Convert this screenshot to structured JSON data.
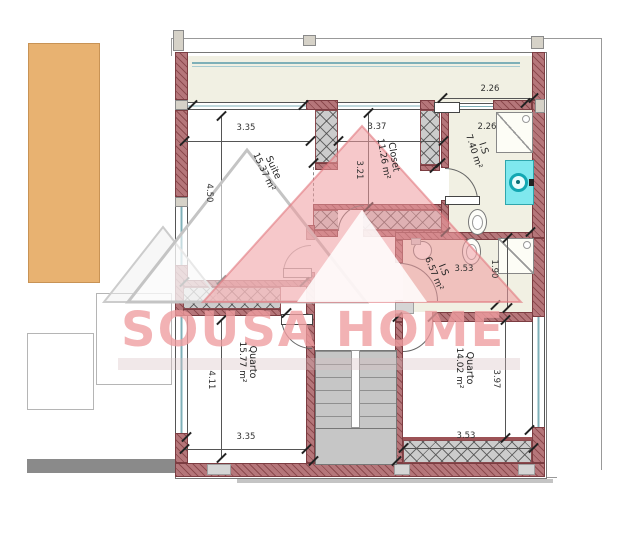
{
  "brand": {
    "watermark_text": "SOUSA HOME"
  },
  "rooms": {
    "suite": {
      "name": "Suite",
      "area": "15.37 m²"
    },
    "closet": {
      "name": "Closet",
      "area": "11.26 m²"
    },
    "bathroom_top": {
      "name": "I.S",
      "area": "7.40 m²"
    },
    "bathroom_mid": {
      "name": "I.S",
      "area": "6.57 m²"
    },
    "bedroom_left": {
      "name": "Quarto",
      "area": "15.77 m²"
    },
    "bedroom_right": {
      "name": "Quarto",
      "area": "14.02 m²"
    }
  },
  "dimensions": {
    "suite_width": "3.35",
    "suite_height": "4.50",
    "closet_width": "3.37",
    "closet_height": "3.21",
    "bathroom_top_width_outer": "2.26",
    "bathroom_top_width_inner": "2.26",
    "bathroom_mid_width": "3.53",
    "bathroom_mid_depth": "1.90",
    "bedroom_left_width": "3.35",
    "bedroom_left_height": "4.11",
    "bedroom_right_width": "3.53",
    "bedroom_right_height": "3.97"
  },
  "colors": {
    "wall": "#b5767a",
    "wardrobe_hatch": "#cccccc",
    "watermark_pink": "#ef9da0",
    "sink_cyan": "#7fe8ee",
    "floor_cream": "#f1f0e3",
    "neighbor_tan": "#e8b271",
    "stairs_gray": "#c6c6c6",
    "glass_teal": "#7fb0b8"
  }
}
